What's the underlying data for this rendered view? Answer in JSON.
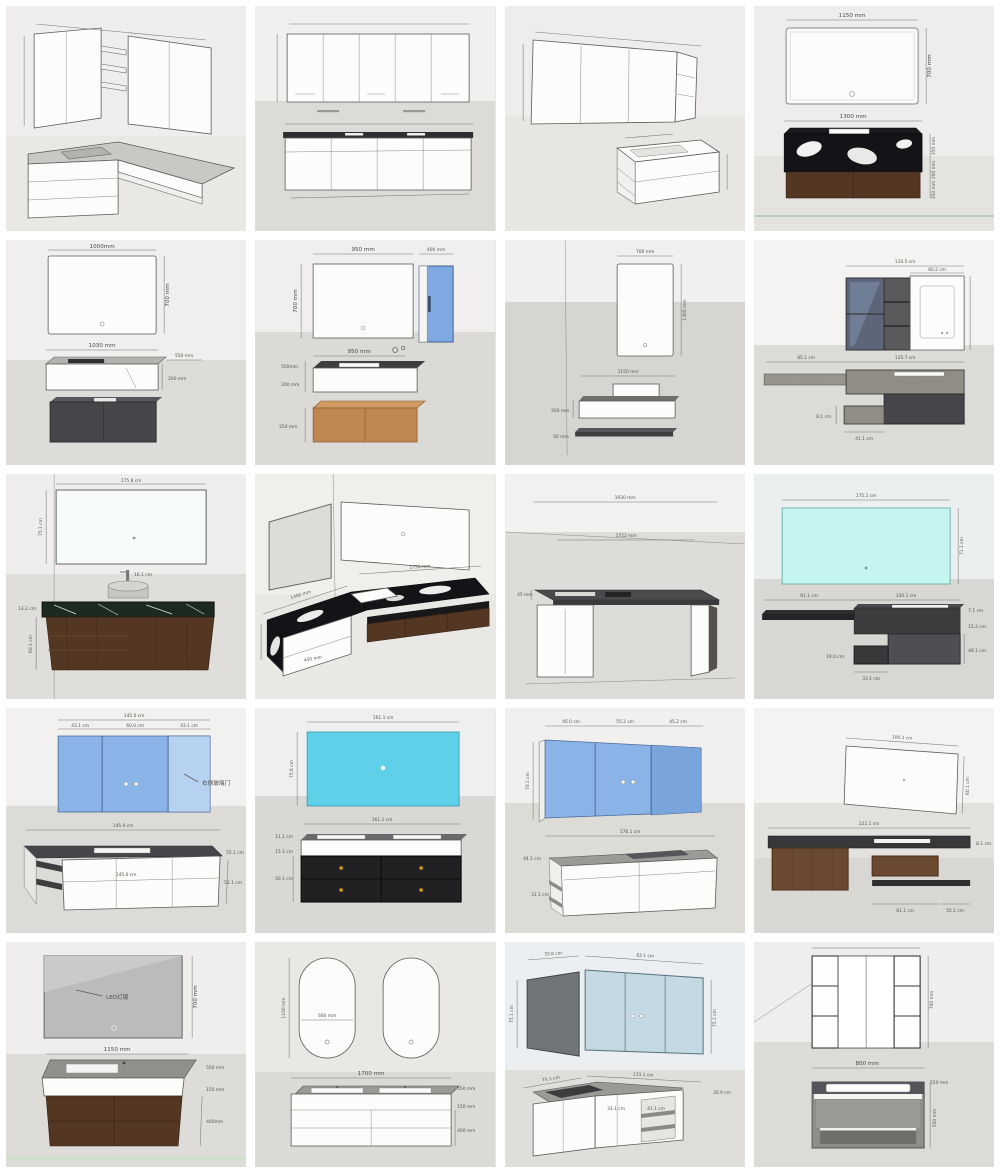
{
  "page": {
    "title": "Bathroom vanity dimension drawings collage"
  },
  "cells": [
    {
      "name": "corner-vanity-wall-cabinets",
      "dims": {}
    },
    {
      "name": "wide-mirror-cabinet-four-door-vanity",
      "dims": {}
    },
    {
      "name": "iso-mirror-cabinet-floating-vanity",
      "dims": {}
    },
    {
      "name": "mirror-marble-vanity",
      "dims": {
        "mirror_w": "1150 mm",
        "mirror_h": "700 mm",
        "vanity_w": "1300 mm",
        "h1": "350 mm",
        "h2": "200 mm",
        "h3": "350 mm"
      }
    },
    {
      "name": "mirror-basin-grey-cabinet",
      "dims": {
        "mirror_w": "1000mm",
        "mirror_h": "700 mm",
        "basin_w": "1030 mm",
        "depth": "550 mm",
        "basin_h": "200 mm"
      }
    },
    {
      "name": "mirror-blue-side-cabinet",
      "dims": {
        "mirror_w": "950 mm",
        "side_w": "400 mm",
        "mirror_h": "700 mm",
        "basin_w": "950 mm",
        "depth": "550mm",
        "basin_h": "200 mm",
        "base_h": "250 mm"
      }
    },
    {
      "name": "tall-mirror-shelf-vanity",
      "dims": {
        "mirror_w": "700 mm",
        "mirror_h": "1300 mm",
        "vanity_w": "1150 mm",
        "vanity_h": "200 mm",
        "shelf_t": "50 mm"
      }
    },
    {
      "name": "dark-glass-cabinet-marble-shelf",
      "dims": {
        "cab_w": "110.5 cm",
        "mirror_w": "60.2 cm",
        "shelf_l": "85.1 cm",
        "shelf_r": "125.7 cm",
        "drawer_h": "8.1 cm",
        "drawer_w": "41.1 cm"
      }
    },
    {
      "name": "wide-mirror-green-marble-vanity",
      "dims": {
        "mirror_w": "175.8 cm",
        "mirror_h": "75.1 cm",
        "faucet": "16.1 cm",
        "counter": "13.2 cm",
        "cab_h": "60.1 cm"
      }
    },
    {
      "name": "l-shaped-marble-corner-vanity",
      "dims": {
        "top_w": "1750 mm",
        "left_w": "1400 mm",
        "front_h": "450 mm"
      }
    },
    {
      "name": "console-desk-vanity",
      "dims": {
        "total_w": "1930 mm",
        "top_w": "1722 mm",
        "th": "45 mm"
      }
    },
    {
      "name": "cyan-mirror-charcoal-vanity",
      "dims": {
        "mirror_w": "175.1 cm",
        "mirror_h": "71.1 cm",
        "left_w": "61.1 cm",
        "right_w": "120.1 cm",
        "top_th": "7.1 cm",
        "r1": "15.2 cm",
        "r2": "48.1 cm",
        "box_w": "33.1 cm",
        "box_h": "19.0 cm"
      }
    },
    {
      "name": "blue-triple-mirror-cabinet-vanity",
      "dims": {
        "total_w": "145.0 cm",
        "m1": "43.1 cm",
        "m2": "60.0 cm",
        "m3": "43.1 cm",
        "note": "右侧玻璃门",
        "vanity_w": "145.0 cm",
        "front_w": "145.0 cm",
        "depth": "55.1 cm",
        "height": "52.1 cm"
      }
    },
    {
      "name": "cyan-mirror-black-drawer-vanity",
      "dims": {
        "mirror_w": "161.1 cm",
        "mirror_h": "75.6 cm",
        "vanity_w": "161.1 cm",
        "t1": "11.1 cm",
        "t2": "15.1 cm",
        "t3": "50.1 cm"
      }
    },
    {
      "name": "blue-mirror-cabinet-shelf-vanity",
      "dims": {
        "m1": "45.0 cm",
        "m2": "55.2 cm",
        "m3": "45.2 cm",
        "mirror_h": "70.1 cm",
        "vanity_w": "176.1 cm",
        "depth": "44.1 cm",
        "shelf": "31.1 cm"
      }
    },
    {
      "name": "mirror-long-floating-vanity",
      "dims": {
        "mirror_w": "100.1 cm",
        "mirror_h": "60.1 cm",
        "vanity_w": "222.1 cm",
        "th": "8.1 cm",
        "seg1": "81.1 cm",
        "seg2": "55.1 cm"
      }
    },
    {
      "name": "grey-mirror-wood-drawer-vanity",
      "dims": {
        "note": "LED灯镜",
        "mirror_h": "700 mm",
        "vanity_w": "1150 mm",
        "depth": "550 mm",
        "band": "150 mm",
        "drawer_h": "400mm"
      }
    },
    {
      "name": "double-oval-mirror-vanity",
      "dims": {
        "mirror_h": "1100 mm",
        "mirror_w": "600 mm",
        "vanity_w": "1700 mm",
        "depth": "550 mm",
        "band": "150 mm",
        "height": "400 mm"
      }
    },
    {
      "name": "corner-mirror-cabinet-l-vanity",
      "dims": {
        "top_l": "33.8 cm",
        "top_r": "83.1 cm",
        "left_h": "75.1 cm",
        "right_h": "75.1 cm",
        "base_l": "75.1 cm",
        "base_w": "133.1 cm",
        "depth": "26.9 cm",
        "f1": "33.1 cm",
        "f2": "41.1 cm"
      }
    },
    {
      "name": "mirror-cabinet-grey-vanity",
      "dims": {
        "mirror_h": "700 mm",
        "vanity_w": "800 mm",
        "depth": "550 mm",
        "height": "550 mm"
      }
    }
  ]
}
